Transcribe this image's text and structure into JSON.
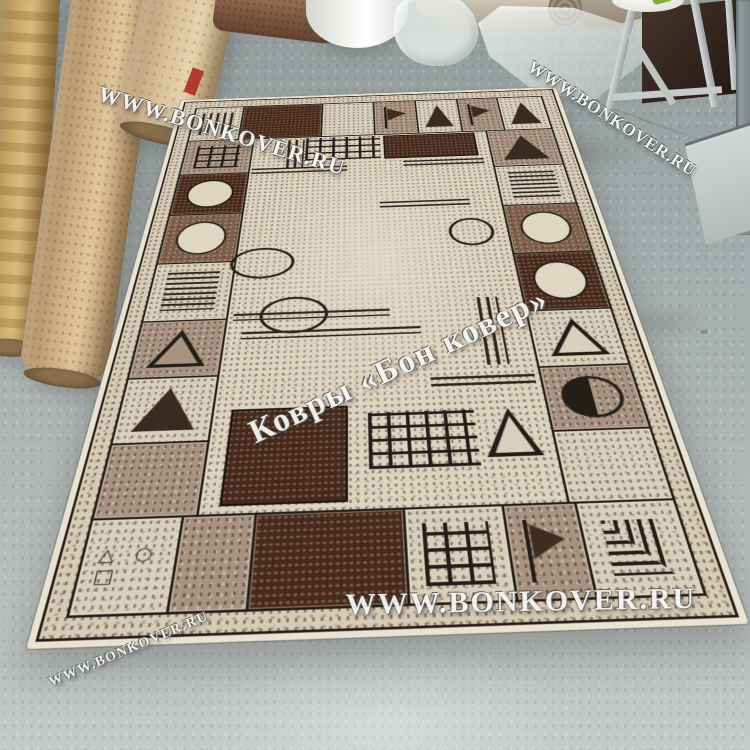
{
  "watermarks": {
    "site_text": "WWW.BONKOVER.RU",
    "brand_text": "Ковры «Бон ковер»",
    "occurrences": [
      {
        "name": "watermark-top-left",
        "text": "site"
      },
      {
        "name": "watermark-top-right",
        "text": "site"
      },
      {
        "name": "watermark-center",
        "text": "brand"
      },
      {
        "name": "watermark-bottom",
        "text": "site"
      },
      {
        "name": "watermark-bottom-left",
        "text": "site"
      }
    ]
  },
  "palette": {
    "floor_gray": "#a8b0b1",
    "carpet_cream": "#d9d0bc",
    "carpet_taupe": "#a89380",
    "carpet_brown": "#7d5f4b",
    "carpet_chocolate": "#482a1b",
    "pattern_outline": "#241e18",
    "roll_tan": "#c7a87e",
    "roll_gold": "#bd9a64",
    "metal_gray": "#c3c7c8",
    "red_label": "#b23b30",
    "green_item": "#7fae3e"
  },
  "scene": {
    "objects": [
      "rolled-carpet-gold",
      "rolled-carpet-tan",
      "rolled-carpet-beige",
      "rolled-carpet-brown-horizontal",
      "foam-roll",
      "plastic-bag",
      "plastic-sheet",
      "stacked-rolls",
      "metal-rack",
      "white-bowl",
      "warehouse-floor",
      "carpet"
    ]
  },
  "carpet": {
    "shapes_glyphs": "△ ○ □",
    "border_top": [
      {
        "w": 60,
        "bg": "cream",
        "m": "bars-v"
      },
      {
        "w": 100,
        "bg": "choco",
        "m": "none"
      },
      {
        "w": 64,
        "bg": "cream",
        "m": "none"
      },
      {
        "w": 52,
        "bg": "taupe",
        "m": "flag"
      },
      {
        "w": 52,
        "bg": "cream",
        "m": "tri-f"
      },
      {
        "w": 50,
        "bg": "taupe",
        "m": "flag"
      },
      {
        "w": 56,
        "bg": "cream",
        "m": "tri-f"
      }
    ],
    "border_right": [
      {
        "h": 78,
        "bg": "taupe",
        "m": "tri-f"
      },
      {
        "h": 76,
        "bg": "cream",
        "m": "bars-h"
      },
      {
        "h": 83,
        "bg": "brown",
        "m": "circle-f"
      },
      {
        "h": 86,
        "bg": "choco",
        "m": "circle-f"
      },
      {
        "h": 73,
        "bg": "cream",
        "m": "tri-o"
      },
      {
        "h": 72,
        "bg": "taupe",
        "m": "half-circle"
      },
      {
        "h": 70,
        "bg": "cream",
        "m": "none"
      }
    ],
    "border_left": [
      {
        "h": 73,
        "bg": "taupe",
        "m": "grid"
      },
      {
        "h": 78,
        "bg": "choco",
        "m": "ellipse-f"
      },
      {
        "h": 83,
        "bg": "brown",
        "m": "circle-f"
      },
      {
        "h": 86,
        "bg": "cream",
        "m": "bars-h"
      },
      {
        "h": 73,
        "bg": "taupe",
        "m": "tri-o"
      },
      {
        "h": 73,
        "bg": "cream",
        "m": "tri-f"
      },
      {
        "h": 72,
        "bg": "taupe",
        "m": "none"
      }
    ],
    "border_bottom": [
      {
        "w": 68,
        "bg": "cream",
        "m": "shapes"
      },
      {
        "w": 54,
        "bg": "taupe",
        "m": "none"
      },
      {
        "w": 112,
        "bg": "choco",
        "m": "none"
      },
      {
        "w": 74,
        "bg": "cream",
        "m": "grid"
      },
      {
        "w": 54,
        "bg": "taupe",
        "m": "flag"
      },
      {
        "w": 74,
        "bg": "cream",
        "m": "labyrinth"
      }
    ],
    "inner_motifs": [
      {
        "x": 42,
        "y": 5,
        "w": 20,
        "h": 62,
        "t": "bars-v"
      },
      {
        "x": 64,
        "y": 2,
        "w": 90,
        "h": 50,
        "t": "grid"
      },
      {
        "x": 158,
        "y": 2,
        "w": 112,
        "h": 52,
        "t": "choco"
      },
      {
        "x": 2,
        "y": 66,
        "w": 112,
        "h": 16,
        "t": "bars-h"
      },
      {
        "x": 180,
        "y": 60,
        "w": 95,
        "h": 16,
        "t": "bars-h"
      },
      {
        "x": -6,
        "y": 218,
        "w": 60,
        "h": 44,
        "t": "ellipse-o"
      },
      {
        "x": 150,
        "y": 142,
        "w": 100,
        "h": 14,
        "t": "bars-h"
      },
      {
        "x": 222,
        "y": 178,
        "w": 42,
        "h": 42,
        "t": "circle-o"
      },
      {
        "x": 30,
        "y": 298,
        "w": 60,
        "h": 46,
        "t": "circle-o"
      },
      {
        "x": 5,
        "y": 320,
        "w": 150,
        "h": 10,
        "t": "bars-h"
      },
      {
        "x": 15,
        "y": 346,
        "w": 168,
        "h": 10,
        "t": "bars-h"
      },
      {
        "x": 240,
        "y": 308,
        "w": 20,
        "h": 92,
        "t": "bars-v"
      },
      {
        "x": 188,
        "y": 413,
        "w": 92,
        "h": 12,
        "t": "bars-h"
      },
      {
        "x": 15,
        "y": 443,
        "w": 100,
        "h": 100,
        "t": "choco"
      },
      {
        "x": 132,
        "y": 452,
        "w": 90,
        "h": 60,
        "t": "grid"
      },
      {
        "x": 228,
        "y": 452,
        "w": 46,
        "h": 52,
        "t": "tri-o"
      }
    ]
  }
}
